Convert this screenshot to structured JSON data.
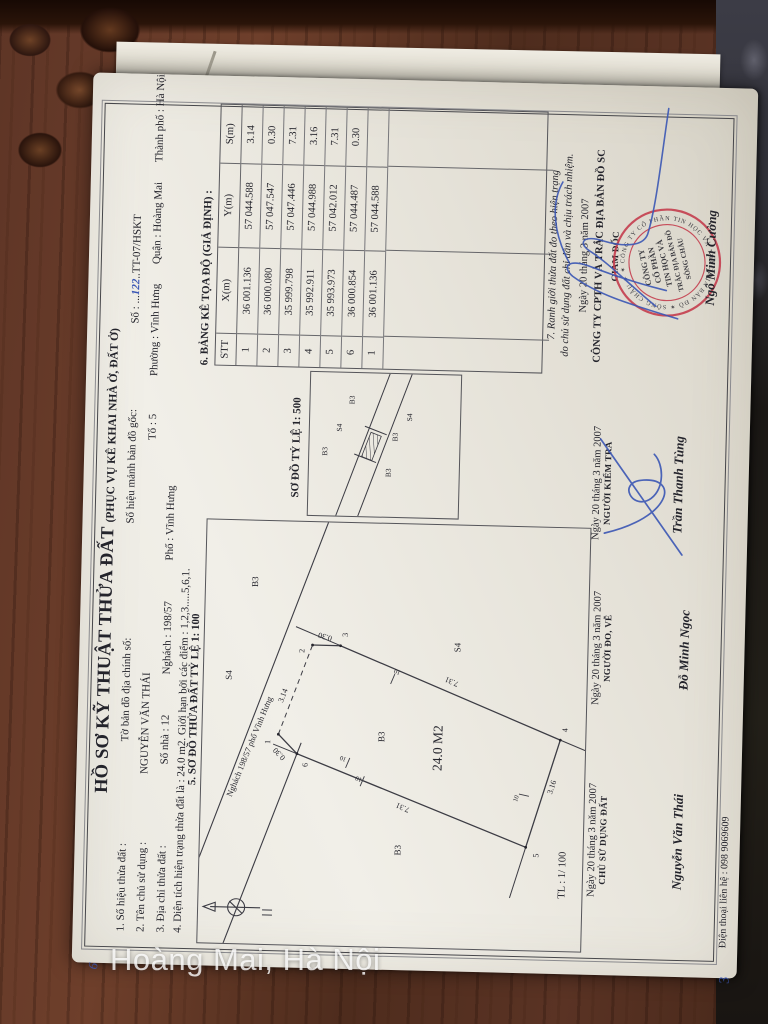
{
  "photo": {
    "location_watermark": "Hoàng Mai, Hà Nội",
    "pen_mark_left": "6",
    "pen_mark_right": "3"
  },
  "colors": {
    "stamp_red": "#c43a4b",
    "ink_blue": "#3a56b4",
    "paper": "#ece9e1",
    "wood": "#5e3526"
  },
  "doc": {
    "title": "HỒ SƠ KỸ THUẬT THỬA ĐẤT",
    "title_suffix": "(PHỤC VỤ KÊ KHAI NHÀ Ở, ĐẤT Ở)",
    "doc_no_label": "Số :",
    "doc_no_dots_left": "...",
    "doc_no_value": "122",
    "doc_no_code": "..TT-07/HSKT",
    "line1": {
      "item": "1. Số hiệu thửa đất :",
      "map_sheet": "Tờ bản đồ địa chính số:",
      "orig_sheet": "Số hiệu mảnh bản đồ gốc:"
    },
    "line2": {
      "item": "2. Tên chủ sử dụng :",
      "owner": "NGUYỄN VĂN THÁI",
      "to": "Tổ : 5",
      "phuong": "Phường : Vĩnh Hưng",
      "quan": "Quận : Hoàng Mai",
      "thanhpho": "Thành phố : Hà Nội"
    },
    "line3": {
      "item": "3. Địa chỉ thửa đất :",
      "sonha": "Số nhà : 12",
      "ngach": "Nghách : 198/57",
      "pho": "Phố :  Vĩnh Hưng"
    },
    "line4": "4. Diện tích hiện trạng thửa đất là :  24.0   m2. Giới hạn bởi các điểm : 1,2,3.....5,6,1.",
    "heading5": "5. SƠ ĐỒ THỬA ĐẤT TỶ LỆ   1: 100",
    "heading6": "6. BẢNG KÊ TỌA ĐỘ (GIẢ ĐỊNH) :",
    "table": {
      "headers": [
        "STT",
        "X(m)",
        "Y(m)",
        "S(m)"
      ],
      "rows": [
        [
          "1",
          "36 001.136",
          "57 044.588",
          "3.14"
        ],
        [
          "2",
          "36 000.080",
          "57 047.547",
          "0.30"
        ],
        [
          "3",
          "35 999.798",
          "57 047.446",
          "7.31"
        ],
        [
          "4",
          "35 992.911",
          "57 044.988",
          "3.16"
        ],
        [
          "5",
          "35 993.973",
          "57 042.012",
          "7.31"
        ],
        [
          "6",
          "36 000.854",
          "57 044.487",
          "0.30"
        ],
        [
          "1",
          "36 001.136",
          "57 044.588",
          ""
        ]
      ]
    },
    "note7_line1": "7. Ranh giới thửa đất đo theo hiện trạng",
    "note7_line2": "do chủ sử dụng đất chỉ dẫn và chịu trách nhiệm.",
    "date_line": "Ngày  20  tháng  3    năm 2007",
    "company_line": "CÔNG TY CPTH VÀ TRẮC ĐỊA BẢN ĐỒ SC",
    "director_role": "GIÁM ĐỐC",
    "signers": {
      "owner": {
        "date": "Ngày  20  tháng  3    năm 2007",
        "role": "CHỦ SỬ DỤNG ĐẤT",
        "name": "Nguyễn Văn Thái"
      },
      "drafter": {
        "date": "Ngày  20  tháng  3    năm 2007",
        "role": "NGƯỜI ĐO, VẼ",
        "name": "Đỗ Minh Ngọc"
      },
      "checker": {
        "date": "Ngày  20  tháng  3    năm 2007",
        "role": "NGƯỜI KIỂM TRA",
        "name": "Trần Thanh Tùng"
      },
      "director_name": "Ngô Minh Cường"
    },
    "phone_line": "Điện thoại liên hệ :  098 9069609",
    "stamp": {
      "ring_text": "✶ CÔNG TY CỔ PHẦN TIN HỌC VÀ TRẮC ĐỊA BẢN ĐỒ ✶ SÔNG CHÂU ✶ TP HÀ NỘI",
      "center_lines": [
        "CÔNG TY",
        "CỔ PHẦN",
        "TIN HỌC VÀ",
        "TRẮC ĐỊA BẢN ĐỒ",
        "SÔNG CHÂU"
      ]
    },
    "inset": {
      "heading": "SƠ ĐỒ TỶ LỆ   1: 500",
      "labels": [
        {
          "t": "B3",
          "x": 64,
          "y": 18
        },
        {
          "t": "S4",
          "x": 88,
          "y": 32
        },
        {
          "t": "B3",
          "x": 116,
          "y": 44
        },
        {
          "t": "B3",
          "x": 44,
          "y": 82
        },
        {
          "t": "B3",
          "x": 80,
          "y": 88
        },
        {
          "t": "S4",
          "x": 100,
          "y": 102
        }
      ]
    },
    "plot": {
      "points": [
        {
          "n": "1",
          "x": 210,
          "y": 76,
          "lx": 202,
          "ly": 68
        },
        {
          "n": "2",
          "x": 300,
          "y": 108,
          "lx": 294,
          "ly": 100
        },
        {
          "n": "3",
          "x": 300,
          "y": 136,
          "lx": 311,
          "ly": 143
        },
        {
          "n": "4",
          "x": 211,
          "y": 358,
          "lx": 221,
          "ly": 365
        },
        {
          "n": "5",
          "x": 103,
          "y": 326,
          "lx": 95,
          "ly": 339
        },
        {
          "n": "6",
          "x": 191,
          "y": 95,
          "lx": 180,
          "ly": 106
        }
      ],
      "texts": [
        {
          "t": "S4",
          "x": 268,
          "y": 28,
          "s": 9,
          "r": 0
        },
        {
          "t": "B3",
          "x": 362,
          "y": 52,
          "s": 9,
          "r": 0
        },
        {
          "t": "Nghách 198/57 phố Vĩnh Hưng",
          "x": 196,
          "y": 50,
          "s": 8.5,
          "r": 21
        },
        {
          "t": "3.14",
          "x": 248,
          "y": 82,
          "s": 8,
          "r": 20
        },
        {
          "t": "0.30",
          "x": 311,
          "y": 121,
          "s": 8,
          "r": -75
        },
        {
          "t": "0.30",
          "x": 192,
          "y": 79,
          "s": 8,
          "r": -45
        },
        {
          "t": "B3",
          "x": 210,
          "y": 182,
          "s": 9,
          "r": 0
        },
        {
          "t": "24.0 M2",
          "x": 200,
          "y": 240,
          "s": 13.5,
          "r": 0
        },
        {
          "t": "7.31",
          "x": 269,
          "y": 249,
          "s": 8,
          "r": -68
        },
        {
          "t": "7.31",
          "x": 142,
          "y": 203,
          "s": 8,
          "r": -68
        },
        {
          "t": "3.16",
          "x": 163,
          "y": 353,
          "s": 8,
          "r": 17
        },
        {
          "t": "S4",
          "x": 301,
          "y": 256,
          "s": 9,
          "r": 0
        },
        {
          "t": "B3",
          "x": 97,
          "y": 201,
          "s": 9,
          "r": 0
        },
        {
          "t": "10",
          "x": 277,
          "y": 194,
          "s": 6.5,
          "r": -68
        },
        {
          "t": "10",
          "x": 189,
          "y": 142,
          "s": 6.5,
          "r": -68
        },
        {
          "t": "10",
          "x": 169,
          "y": 158,
          "s": 6.5,
          "r": -68
        },
        {
          "t": "10",
          "x": 151,
          "y": 317,
          "s": 6.5,
          "r": 17
        },
        {
          "t": "TL : 1/ 100",
          "x": 76,
          "y": 366,
          "s": 10.5,
          "r": 0
        }
      ],
      "street_lines": [
        {
          "x1": 30,
          "y1": -20,
          "x2": 423,
          "y2": 121
        },
        {
          "x1": -5,
          "y1": 24,
          "x2": 202,
          "y2": 99
        }
      ],
      "neighbor_lines": [
        {
          "x1": 300,
          "y1": 136,
          "x2": 318,
          "y2": 91
        },
        {
          "x1": 211,
          "y1": 358,
          "x2": 196,
          "y2": 396
        },
        {
          "x1": 103,
          "y1": 326,
          "x2": 52,
          "y2": 311
        },
        {
          "x1": 191,
          "y1": 95,
          "x2": 200,
          "y2": 71
        }
      ],
      "tick_lines": [
        {
          "x1": 263,
          "y1": 187,
          "x2": 273,
          "y2": 191
        },
        {
          "x1": 178,
          "y1": 144,
          "x2": 188,
          "y2": 148
        },
        {
          "x1": 160,
          "y1": 159,
          "x2": 170,
          "y2": 163
        },
        {
          "x1": 154,
          "y1": 328,
          "x2": 156,
          "y2": 318
        }
      ]
    }
  }
}
